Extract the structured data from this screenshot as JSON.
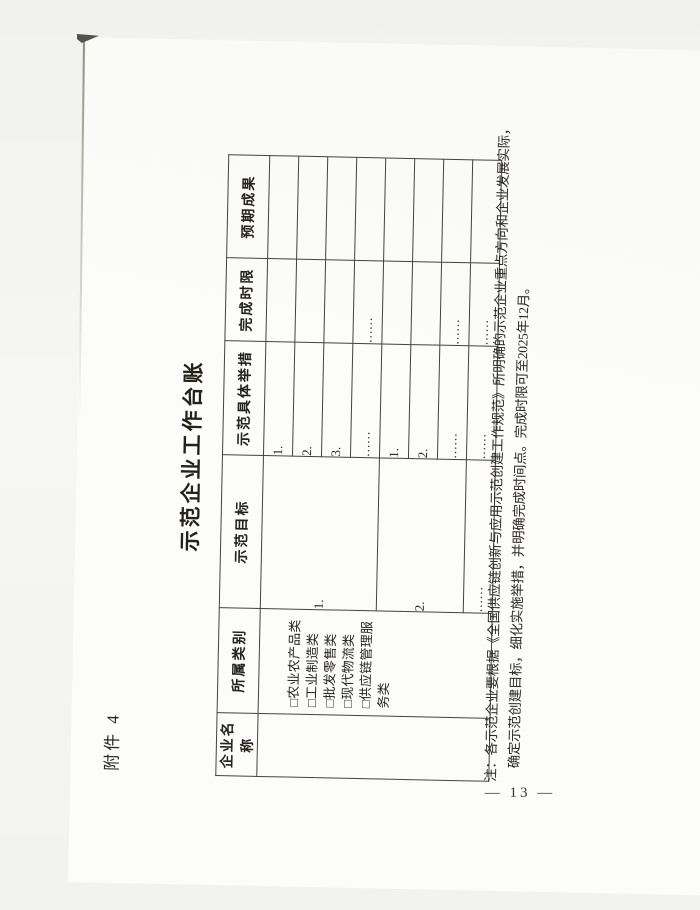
{
  "page": {
    "attachment_label": "附件 4",
    "title": "示范企业工作台账",
    "page_number": "— 13 —"
  },
  "table": {
    "headers": [
      "企业名称",
      "所属类别",
      "示范目标",
      "示范具体举措",
      "完成时限",
      "预期成果"
    ],
    "categories": [
      "□农业农产品类",
      "□工业制造类",
      "□批发零售类",
      "□现代物流类",
      "□供应链管理服务类"
    ],
    "goals": [
      "1.",
      "2.",
      "……"
    ],
    "rows": [
      {
        "measure": "1.",
        "deadline": "",
        "expected": ""
      },
      {
        "measure": "2.",
        "deadline": "",
        "expected": ""
      },
      {
        "measure": "3.",
        "deadline": "",
        "expected": ""
      },
      {
        "measure": "……",
        "deadline": "……",
        "expected": ""
      },
      {
        "measure": "1.",
        "deadline": "",
        "expected": ""
      },
      {
        "measure": "2.",
        "deadline": "",
        "expected": ""
      },
      {
        "measure": "……",
        "deadline": "……",
        "expected": ""
      },
      {
        "measure": "……",
        "deadline": "……",
        "expected": ""
      }
    ]
  },
  "note": {
    "line1": "注：各示范企业要根据《全国供应链创新与应用示范创建工作规范》所明确的示范企业重点方向和企业发展实际，",
    "line2": "确定示范创建目标，细化实施举措，并明确完成时间点。完成时限可至2025年12月。"
  }
}
